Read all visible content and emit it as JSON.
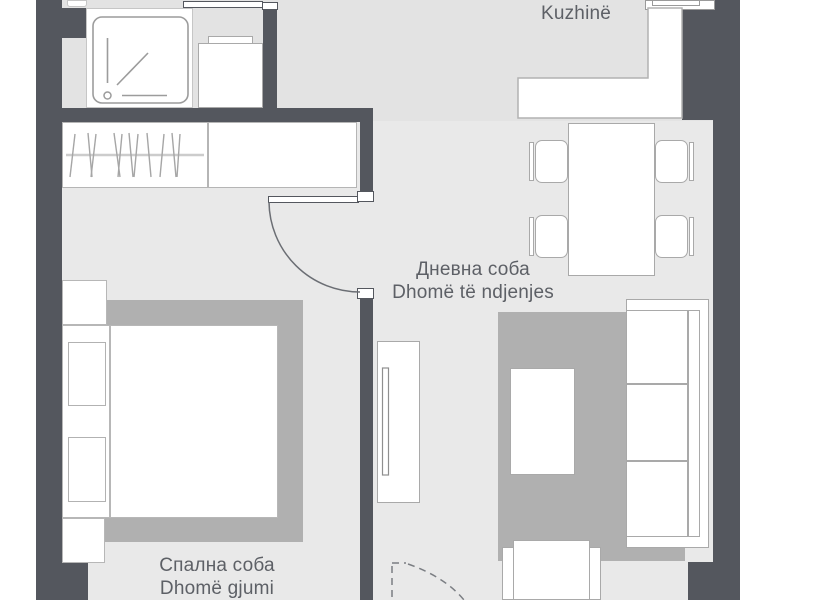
{
  "plan": {
    "type": "apartment-floor-plan",
    "labels": {
      "corridor": {
        "sq": "Korridor"
      },
      "kitchen": {
        "mk": "Кујна",
        "sq": "Kuzhinë"
      },
      "living_room": {
        "mk": "Дневна соба",
        "sq": "Dhomë të ndjenjes"
      },
      "bedroom": {
        "mk": "Спална соба",
        "sq": "Dhomë gjumi"
      }
    },
    "colors": {
      "wall": "#54575e",
      "floor_upper": "#e3e3e3",
      "floor_lower": "#e9e9e9",
      "rug": "#b0b0b0",
      "furniture": "#ffffff",
      "outline": "#a9a9a9",
      "text": "#5d6066",
      "page_background": "#ffffff"
    }
  }
}
